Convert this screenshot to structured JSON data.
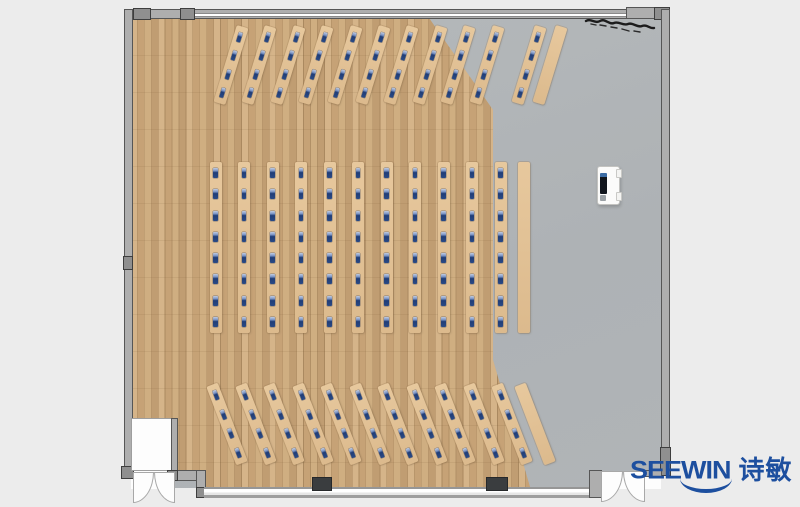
{
  "watermark": {
    "brand_en": "SEEWIN",
    "brand_cn": "诗敏",
    "color": "#1d4f9f"
  },
  "palette": {
    "background": "#ececec",
    "wood_floor": "#cba97d",
    "hard_floor": "#b1b5b8",
    "desk": "#e2c195",
    "seat_blue": "#2a4a85",
    "wall": "#aeaeae",
    "pillar": "#3a3d3f"
  },
  "floorplan": {
    "description": "Top-down training-room layout: three banks of long desks with blue seat markers on a parquet wood floor, hard gray floor at right with mobile lectern, window wall and two double doors at bottom, plant scribble at top right",
    "features": [
      "wood-parquet-floor",
      "hard-floor-area",
      "entry-vestibule",
      "double-door-left",
      "double-door-right",
      "window-wall-bottom",
      "pillar-x2",
      "lectern",
      "plant-scribble"
    ],
    "totals": {
      "desk_strips": 36,
      "seats": 176
    },
    "banks": [
      {
        "id": "front-angled-rows",
        "angle_deg": 17,
        "desk_width": 12,
        "desk_length": 80,
        "y": 25,
        "desks": [
          {
            "x": 225,
            "seats": 4
          },
          {
            "x": 253,
            "seats": 4
          },
          {
            "x": 282,
            "seats": 4
          },
          {
            "x": 310,
            "seats": 4
          },
          {
            "x": 339,
            "seats": 4
          },
          {
            "x": 367,
            "seats": 4
          },
          {
            "x": 395,
            "seats": 4
          },
          {
            "x": 424,
            "seats": 4
          },
          {
            "x": 452,
            "seats": 4
          },
          {
            "x": 481,
            "seats": 4
          },
          {
            "x": 523,
            "seats": 4
          },
          {
            "x": 544,
            "seats": 0
          }
        ]
      },
      {
        "id": "middle-straight-rows",
        "angle_deg": 0,
        "desk_width": 12,
        "desk_length": 171,
        "y": 162,
        "desks": [
          {
            "x": 209.5,
            "seats": 8
          },
          {
            "x": 238,
            "seats": 8
          },
          {
            "x": 266.5,
            "seats": 8
          },
          {
            "x": 295,
            "seats": 8
          },
          {
            "x": 323.5,
            "seats": 8
          },
          {
            "x": 352,
            "seats": 8
          },
          {
            "x": 380.5,
            "seats": 8
          },
          {
            "x": 409,
            "seats": 8
          },
          {
            "x": 437.5,
            "seats": 8
          },
          {
            "x": 466,
            "seats": 8
          },
          {
            "x": 494.5,
            "seats": 8
          },
          {
            "x": 518,
            "seats": 0
          }
        ]
      },
      {
        "id": "back-angled-rows",
        "angle_deg": -21,
        "desk_width": 12,
        "desk_length": 84,
        "y": 382,
        "desks": [
          {
            "x": 221,
            "seats": 4
          },
          {
            "x": 249.5,
            "seats": 4
          },
          {
            "x": 278,
            "seats": 4
          },
          {
            "x": 306.5,
            "seats": 4
          },
          {
            "x": 335,
            "seats": 4
          },
          {
            "x": 363.5,
            "seats": 4
          },
          {
            "x": 392,
            "seats": 4
          },
          {
            "x": 420.5,
            "seats": 4
          },
          {
            "x": 449,
            "seats": 4
          },
          {
            "x": 477.5,
            "seats": 4
          },
          {
            "x": 506,
            "seats": 4
          },
          {
            "x": 529,
            "seats": 0
          }
        ]
      }
    ]
  }
}
